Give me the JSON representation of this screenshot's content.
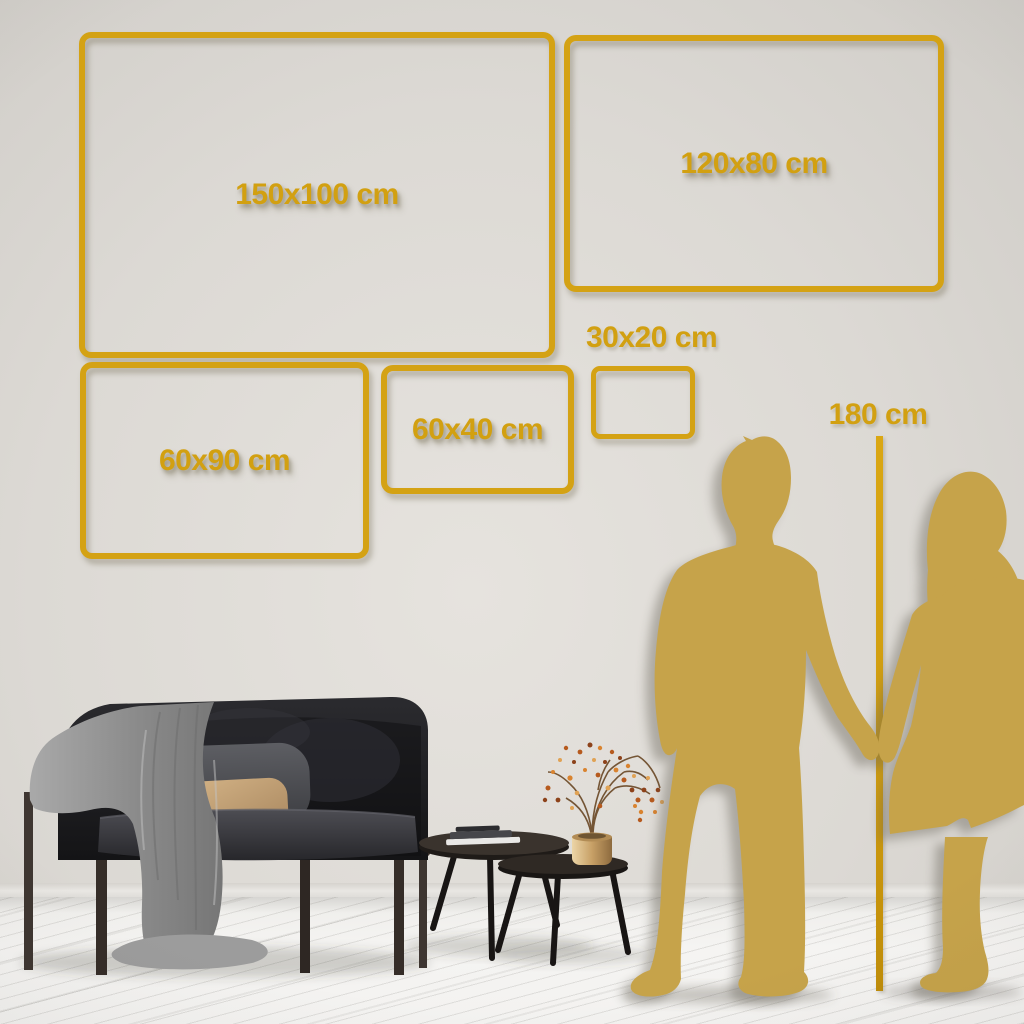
{
  "scene": {
    "description": "Canvas wall-art size comparison guide in a living room with couple silhouette height reference",
    "size_frames": [
      {
        "id": "150x100",
        "label": "150x100 cm"
      },
      {
        "id": "120x80",
        "label": "120x80 cm"
      },
      {
        "id": "60x90",
        "label": "60x90 cm"
      },
      {
        "id": "60x40",
        "label": "60x40 cm"
      },
      {
        "id": "30x20",
        "label": "30x20 cm"
      }
    ],
    "height_reference": {
      "label": "180 cm"
    },
    "colors": {
      "frame_gold": "#D4A214",
      "label_gold": "#D2A011",
      "silhouette_gold": "#C6A34A",
      "wall": "#DCD9D4",
      "floor": "#F4F3F1"
    }
  }
}
